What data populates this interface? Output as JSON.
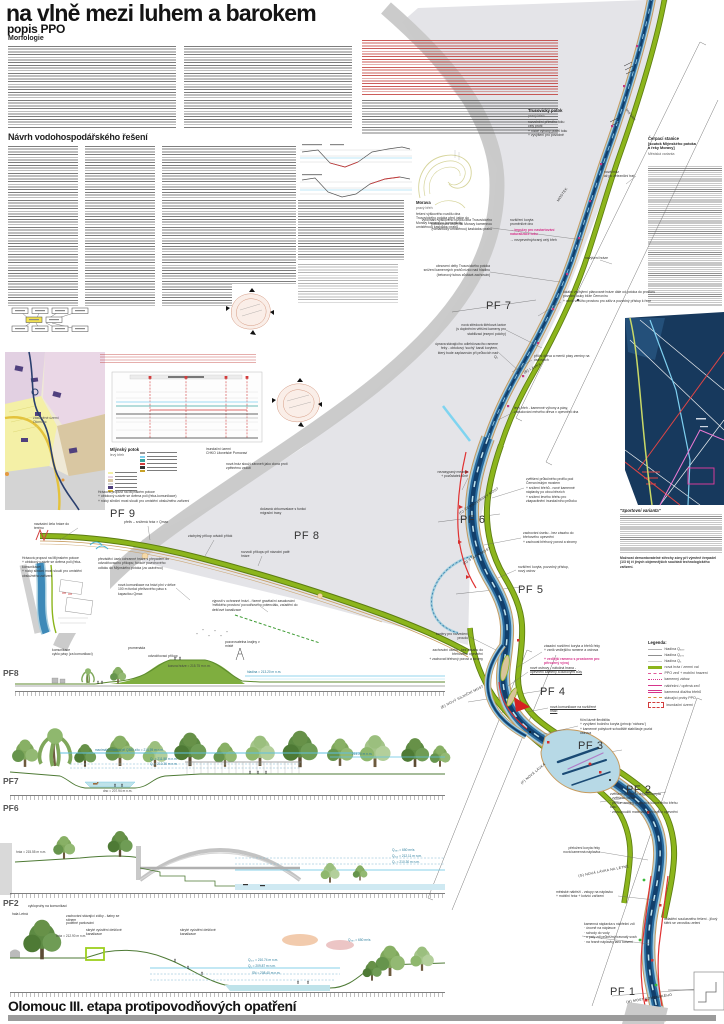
{
  "header": {
    "title": "na vlně mezi luhem a barokem",
    "subtitle": "popis PPO",
    "section1": "Morfologie",
    "section2": "Návrh vodohospodářského řešení"
  },
  "footer": {
    "title": "Olomouc III. etapa protipovodňových opatření"
  },
  "pf": {
    "pf1": "PF 1",
    "pf2": "PF 2",
    "pf3": "PF 3",
    "pf4": "PF 4",
    "pf5": "PF 5",
    "pf6": "PF 6",
    "pf7": "PF 7",
    "pf8": "PF 8",
    "pf9": "PF 9"
  },
  "strips": {
    "pf8": {
      "label": "PF8",
      "a1": "komunikace\ncyklo pásy (za komunikací)",
      "a2": "promenáda",
      "a3": "odvodňovací příkop",
      "a4": "pozorovatelna krajiny v místě",
      "l1": "koruna hráze = 215.75 m n.m.",
      "l2": "hladina = 213.20 m n.m."
    },
    "view": {
      "l1": "maximální hladina při Q380 z/to = 214.59 m n.m.",
      "l2": "214.20 m n.m."
    },
    "pf7": {
      "label": "PF7",
      "l1": "Q₅ = 211.58 m n.m.",
      "l2": "Q₁ = 210.36 m n.m.",
      "l3": "dno = 207.94 m n.m."
    },
    "pf6": {
      "label": "PF6",
      "l0": "hráz = 215.55 m n.m.",
      "l1": "Q₃₈₀ = 650 m³/s",
      "l2": "Q₁₀₀ = 212.11 m n.m.",
      "l3": "Q₅ = 210.30 m n.m."
    },
    "pf2": {
      "label": "PF2",
      "a1": "cyklopruhy na komunikaci",
      "a2": "hala Letná",
      "a3": "zachování stávající zídky - šatny se stínem",
      "a4": "podélné parkování",
      "a5": "skryté vyústění dešťové kanalizace",
      "a6": "skryté vyústění dešťové kanalizace",
      "l0": "hráz = 212.90 m n.m.",
      "l1": "Q₁₀₀ = 210.74 m n.m.",
      "l2": "Q₅ = 209.87 m n.m.",
      "l3": "SN = 208.40 m n.m.",
      "l4": "Q₃₈₀ = 650 m³/s"
    }
  },
  "labels": {
    "trusovicky": "Trusovický potok",
    "trus_sub": "pravý břeh",
    "trus_note": "rozvolnění přímého toku\ncelý profil\n+ nízké výhony podél toku\n+ vyvýšení pro povodně",
    "morava": "Morava",
    "morava_sub": "pravý břeh",
    "morava_note": "řešení výškového rozdílu dna Trusovického potoka před ústím do Moravy kamennou (romanticky umístěnou) kaskádou prahů",
    "levy_breh": "levý břeh",
    "mostek": "MOSTEK",
    "mlynsky": "Mlýnský potok",
    "mlynsky_sub": "levý břeh",
    "inundace": "inundační území\nCHKO Litovelské Pomoraví",
    "hraz_note": "nová hráz slouží zároveň jako clona proti zpětnému vzdutí",
    "propust": "Hrázová propust na Mlýnském potoce\n+ obtokový uzávěr se dvěma poli (řeka-komunikace)\n+ nízký silniční most slouží pro umístění obslužného zařízení",
    "olomouc_map": "zastavěné území\nOlomouc"
  },
  "bridges": {
    "b": "(B) LÁVKA",
    "c": "(C) ČERNOVÍRSKÝ MOST",
    "d": "(D) STARÝ MOST",
    "e": "(E) NOVÝ SILNIČNÍ MOST",
    "f": "(F) NOVÁ LÁVKA",
    "g": "(G) NOVÁ LÁVKA NA LETNÉ",
    "h": "(H) MOST KOMENSKÉHO"
  },
  "right_col": {
    "cerpaci_h": "Čerpací stanice",
    "cerpaci_s1": "[soutok Mlýnského potoka",
    "cerpaci_s2": "a řeky Moravy]",
    "cerpaci_s3": "Městská varianta",
    "sport_h": "\"Sportovní varianta\"",
    "sport_note": "Možnost demontovatelné střechy zóny při výměně čerpadel (1/3 tí) či jiných objemnějších součástí technologického zařízení.",
    "legend_title": "Legenda:"
  },
  "legend": [
    "hladina Q₃₈₀",
    "hladina Q₁₀₀",
    "hladina Q₅",
    "nová hráz / zemní val",
    "PPO zeď + mobilní hrazení",
    "kamenný zához",
    "nábřežní / opěrná zeď",
    "kamenná dlažba břehů",
    "stávající prvky PPO",
    "inundační území"
  ],
  "ann": [
    "nová hráz\naž po železniční trať",
    "navýšení hráze",
    "vyrovnání výškového rozdílu dna Trusovického potoka před ústím do Moravy kamennou (romanticky umístěnou) kaskádou prahů",
    "rozšíření koryta\nproměnlivé dno",
    "→ impulzy pro nastartování naturalizace toku",
    "→ nezpevněný/oraný celý břeh",
    "obnovení delty Trusovického potoka\nsnížení kamenných prahů nízko nad hladinu\n(betonový tubus zůstává zachován)",
    "lokální vychýlení plánované hráze dále od potoka do prostoru povodní louky blíže Černovíru\n+ vznik většího prostoru pro záliv a pozvolný přístup k řece",
    "levý břeh - kamenné výhony a pásy, zabudování mrtvého dřeva v opevnění dna",
    "nezasypaný meandr\n+ pozůstatek tůně",
    "nová středová štěrková lavice\n(s doplněním většími kameny pro stabilizaci jesepní polohy)",
    "úprava stávajícího odlehčovacího ramene řeky - obtokový 'suchý' kanál korytem, který bude zaplavován při průtocích nad Q₅",
    "příční dřeva a menší pásy zeminy na ostrovech",
    "zvětšení průtočného profilu pod Černovírským mostem\n+ snížení břehů - nové kamenné náplavky po obou březích\n+ snížení levého břehu pro zkapacitnění inundačního průtoku",
    "zachování úseku - bez zásahu do břehového opevnění\n+ zachovat břehový porost a stromy",
    "rozšíření koryta, pozvolný přístup, nový ostrov",
    "bariéry pro rozvedení proudu",
    "zásadní rozšíření koryta a břehů řeky\n+ vznik vedlejšího ramene a ostrova",
    "+ vedlejší rameno s prostorem pro přirozený vývoj",
    "nové ostrovy - nátočná hrana -\nopevnění kameny a dubovými kůly",
    "nová komunikace na rozšířené hrázi",
    "říční lázně flexibilita\n+ vyvýšení bočního koryta (princip 'náhonu')\n+ kamenné pobytové schodiště stabilizuje pozici ostrova",
    "zvětšení poloměru oblouku koryta\n· zvětšení rozlivu\n· přesun zeminy do pozice konvexního břehu toku\n· znovupoužití materiálu břehového opevnění",
    "přeložení koryta řeky\nnová kamenná náplavka",
    "městské nábřeží - vstupy na náplavku\n+ mobilní hráz + kotvící zařízení",
    "kamenná náplavka s nábřežní zdí\n· úrovně na náplavce\n· schody do vody\n· u paty zdi průběžný travnatý svah\n· na hraně náplavky lano kotvení",
    "doladění současného řešení - jílový štěrk se vzrostlou zelení",
    "navázání čela hráze do terénu",
    "přeliv – snížená hráz × Qmax",
    "dočasná cirkumvalace s funkcí migrační trasy",
    "záchytný příkop odvádí přítok",
    "rozvodí příkopu při návodní patě hráze",
    "převáděcí úsek ochranné hráze s přepadem do odvodňovacího příkopu; funkce povrchového odtoku do Mlýnského potoka (za uzávěrou)",
    "nová komunikace na hrázi plní v délce 100 m funkci přelivového pásu s kapacitou Qmax",
    "výpusti v ochranné hrázi - řízené gravitační zasakování 'měkkého prostoru' povodňového potenciálu, zaústění do dešťové kanalizace"
  ]
}
